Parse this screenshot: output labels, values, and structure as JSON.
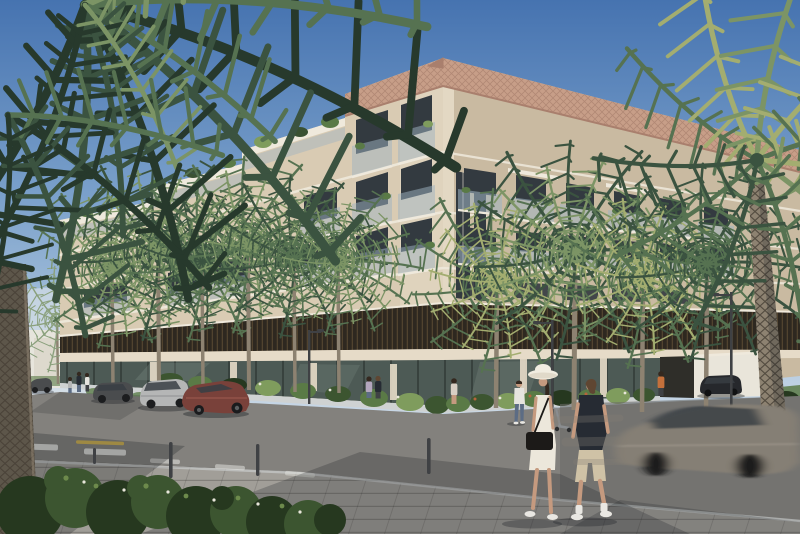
{
  "scene": {
    "title": "Sunny architectural rendering of a modern beige low-rise apartment building on a palm-lined street corner",
    "time_of_day": "daytime, clear blue sky",
    "building": {
      "style": "contemporary stepped mid-rise residential block",
      "storeys_visible": 6,
      "facade_material": "beige stone",
      "roof_detail": "perforated copper-toned fascia band",
      "features": [
        "glass-fronted balconies with green planters",
        "terraced upper floors stepping down to the left",
        "dark timber louvre band wrapping the second level",
        "full-height glazed ground floor with retail frontage",
        "white entry wall and driveway on the right side"
      ]
    },
    "vegetation": {
      "foreground_palm_fronds": "large dark palm fronds overhanging the top-left corner",
      "foreground_palm_trunk": "thick textured palm trunk at the far left edge",
      "right_palm": "tall sunlit palm with full crown at the right edge",
      "street_palms_count": 10,
      "foreground_shrubs": "dense green shrubs with tiny white flowers at bottom left",
      "planters": "flowering hedges along the building base"
    },
    "street": {
      "surfaces": [
        "asphalt roadway",
        "large grey paver sidewalk and corner plaza"
      ],
      "markings": [
        "white dashed lane line",
        "yellow tactile strip at crossing"
      ],
      "furniture": [
        "slim street lamps",
        "dark bollards",
        "parked e-scooter"
      ],
      "parked_cars": [
        "dark car in the far left distance",
        "grey sedan parked on the left",
        "silver hatchback parked on the left",
        "maroon fastback sedan parked nearest on the left",
        "black SUV parked by the right entry wall"
      ],
      "moving_car": "motion-blurred grey-brown car driving to the right"
    },
    "people": {
      "foreground": [
        "woman walking in white midi dress, wide-brim sun hat, black crossbody bag and white sneakers",
        "man walking in dark t-shirt, beige shorts, white socks and sneakers"
      ],
      "background": [
        "man in white shirt and jeans on the far sidewalk",
        "woman standing near the planter",
        "couple standing at the building corner",
        "person in an orange top near the right entrance",
        "small group of pedestrians crossing in the left distance"
      ]
    }
  },
  "palette": {
    "sky_top": "#4673b0",
    "sky_mid": "#7ba1cb",
    "sky_low": "#a9c3dc",
    "sky_horizon": "#d3dee9",
    "facade": "#d9cbb3",
    "facade_shade": "#c9baa1",
    "facade_light": "#e6dbc8",
    "corner_light": "#e3d8c3",
    "slab_white": "#efe9dc",
    "roof_copper": "#c79e88",
    "roof_copper_dark": "#a97f6d",
    "louver_dark": "#2e2820",
    "louver_stripe": "#51432f",
    "window_dark": "#333a40",
    "balcony_glass": "#9fb4c2",
    "glass_store": "#4d5a55",
    "glass_mull": "#2a322e",
    "glass_refl": "#8d9c93",
    "plant_dark": "#3a5132",
    "plant_mid": "#5a7a46",
    "plant_light": "#7f9c5d",
    "palm_deep": "#27392c",
    "palm_dark": "#3b5340",
    "palm_mid": "#567251",
    "palm_light": "#7c9465",
    "palm_sun": "#a3ad70",
    "palm_haze": "#8aa07c",
    "trunk": "#8d8271",
    "trunk_dark": "#5d564a",
    "bark_line": "#463f34",
    "road": "#83817d",
    "road_dark": "#6b6a67",
    "paver": "#a19e98",
    "shadow": "#1c2024",
    "curb": "#cfd2d2",
    "marking_white": "#e8e8e4",
    "marking_yellow": "#d8b74a",
    "bush_deep": "#26381f",
    "bush_mid": "#3c5530",
    "bush_light": "#6d8a4c",
    "flower_white": "#e8e6da",
    "flower_rust": "#b5643c",
    "car_darkgrey": "#4a4c4e",
    "car_silver": "#b5b6b6",
    "car_maroon": "#79413a",
    "car_black": "#26282c",
    "car_blur": "#857f75",
    "car_glass": "#3a3f45",
    "skin": "#c59a7f",
    "hair_brown": "#5f4632",
    "hair_dark": "#34281f",
    "dress_white": "#ece7db",
    "hat_white": "#f1ede1",
    "bag_black": "#1c1a18",
    "tee_dark": "#262b33",
    "shorts_tan": "#cfc2a6",
    "shoe_white": "#e9e7e2",
    "shirt_white": "#e6e4df",
    "jeans": "#5c6c84",
    "accent_orange": "#c4703b",
    "metal": "#3f4144",
    "wall_white": "#e9e5da"
  }
}
